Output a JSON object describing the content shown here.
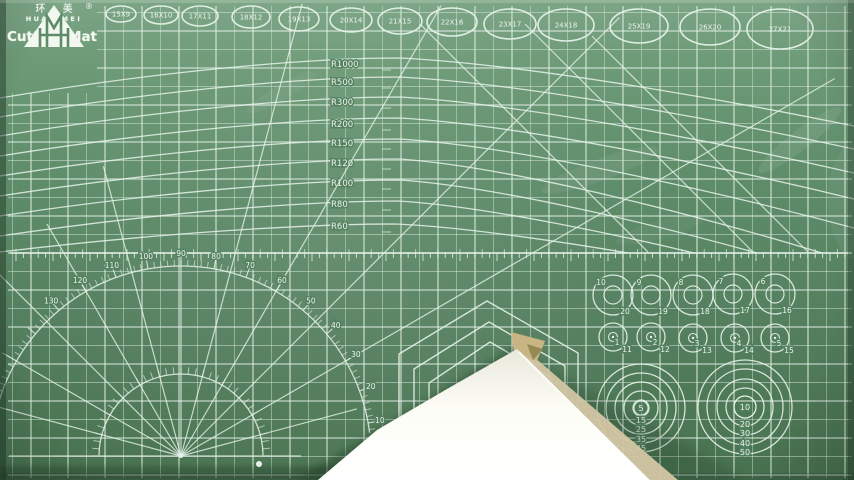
{
  "colors": {
    "mat_top": "#7ca585",
    "mat_mid": "#5e8c69",
    "mat_low": "#547f5e",
    "mat_bottom": "#48724f",
    "grid_line": "#d8e9de",
    "grid_major": "#e6f3ea",
    "template_line": "#e6f2ea",
    "text": "#f3f9f3",
    "halo": "#53805e",
    "paper_white": "#fdfdf6",
    "paper_grey": "#efeee3",
    "paper_beige": "#d3c6a4",
    "fold_tan": "#c9b583",
    "fold_olive": "#8f854f",
    "shadow": "#1c3424"
  },
  "brand": {
    "logo_mark": "HM",
    "registered": "®",
    "name_cn": "环 美",
    "name_en": "HUAN MEI",
    "product": "Cutting Mat"
  },
  "grid": {
    "x0": 12.5,
    "y0": 12.5,
    "step": 18.5,
    "x_min": 8,
    "x_max": 852,
    "y_min": 6,
    "y_max": 478
  },
  "ruler": {
    "y": 253,
    "tick_step": 7.4,
    "tick_len": 5,
    "major_every": 5,
    "x_start": 16,
    "x_end": 850
  },
  "ellipse_templates": [
    {
      "label": "15X9",
      "cx": 121,
      "cy": 14,
      "rx": 15,
      "ry": 8
    },
    {
      "label": "16X10",
      "cx": 161,
      "cy": 15,
      "rx": 17,
      "ry": 9
    },
    {
      "label": "17X11",
      "cx": 200,
      "cy": 16,
      "rx": 18,
      "ry": 10
    },
    {
      "label": "18X12",
      "cx": 251,
      "cy": 17,
      "rx": 19,
      "ry": 11
    },
    {
      "label": "19X13",
      "cx": 299,
      "cy": 19,
      "rx": 20,
      "ry": 12
    },
    {
      "label": "20X14",
      "cx": 351,
      "cy": 20,
      "rx": 21,
      "ry": 12
    },
    {
      "label": "21X15",
      "cx": 400,
      "cy": 21,
      "rx": 22,
      "ry": 13
    },
    {
      "label": "22X16",
      "cx": 452,
      "cy": 22,
      "rx": 25,
      "ry": 14
    },
    {
      "label": "23X17",
      "cx": 510,
      "cy": 24,
      "rx": 26,
      "ry": 15
    },
    {
      "label": "24X18",
      "cx": 566,
      "cy": 25,
      "rx": 28,
      "ry": 16
    },
    {
      "label": "25X19",
      "cx": 639,
      "cy": 26,
      "rx": 29,
      "ry": 17
    },
    {
      "label": "26X20",
      "cx": 710,
      "cy": 27,
      "rx": 30,
      "ry": 18
    },
    {
      "label": "27X21",
      "cx": 780,
      "cy": 29,
      "rx": 33,
      "ry": 20
    }
  ],
  "radius_arcs": {
    "label_x": 331,
    "vertex_tick_x": 382,
    "items": [
      {
        "label": "R1000",
        "label_y": 64,
        "left_y": 98,
        "crest": [
          400,
          58
        ],
        "end": [
          854,
          126
        ]
      },
      {
        "label": "R500",
        "label_y": 82,
        "left_y": 117,
        "crest": [
          400,
          77
        ],
        "end": [
          854,
          149
        ]
      },
      {
        "label": "R300",
        "label_y": 102,
        "left_y": 136,
        "crest": [
          400,
          97
        ],
        "end": [
          854,
          173
        ]
      },
      {
        "label": "R200",
        "label_y": 124,
        "left_y": 156,
        "crest": [
          400,
          118
        ],
        "end": [
          854,
          199
        ]
      },
      {
        "label": "R150",
        "label_y": 143,
        "left_y": 176,
        "crest": [
          400,
          139
        ],
        "end": [
          854,
          228
        ]
      },
      {
        "label": "R120",
        "label_y": 163,
        "left_y": 196,
        "crest": [
          400,
          159
        ],
        "end": [
          822,
          253
        ]
      },
      {
        "label": "R100",
        "label_y": 183,
        "left_y": 216,
        "crest": [
          400,
          180
        ],
        "end": [
          757,
          253
        ]
      },
      {
        "label": "R80",
        "label_y": 204,
        "left_y": 236,
        "crest": [
          398,
          201
        ],
        "end": [
          694,
          253
        ]
      },
      {
        "label": "R60",
        "label_y": 226,
        "left_y": 252,
        "crest": [
          396,
          224
        ],
        "end": [
          628,
          253
        ]
      }
    ]
  },
  "diagonals": [
    {
      "x1": 420,
      "y1": 24,
      "x2": 648,
      "y2": 252
    },
    {
      "x1": 525,
      "y1": 24,
      "x2": 753,
      "y2": 252
    },
    {
      "x1": 592,
      "y1": 36,
      "x2": 808,
      "y2": 252
    }
  ],
  "protractor": {
    "cx": 181,
    "cy": 456,
    "inner_radius": 82,
    "outer_radius": 190,
    "label_radius": 196,
    "degree_labels": [
      {
        "text": "10",
        "angle": 10
      },
      {
        "text": "20",
        "angle": 20
      },
      {
        "text": "30",
        "angle": 30
      },
      {
        "text": "40",
        "angle": 40
      },
      {
        "text": "50",
        "angle": 50
      },
      {
        "text": "60",
        "angle": 60
      },
      {
        "text": "70",
        "angle": 70
      },
      {
        "text": "80",
        "angle": 80
      },
      {
        "text": "90",
        "angle": 90
      },
      {
        "text": "100",
        "angle": 100
      },
      {
        "text": "110",
        "angle": 110
      },
      {
        "text": "120",
        "angle": 120
      },
      {
        "text": "130",
        "angle": 130
      }
    ],
    "rays": [
      {
        "angle": 0,
        "len": 120
      },
      {
        "angle": 15,
        "len": 182
      },
      {
        "angle": 30,
        "len": 755
      },
      {
        "angle": 45,
        "len": 620
      },
      {
        "angle": 60,
        "len": 520
      },
      {
        "angle": 75,
        "len": 468
      },
      {
        "angle": 90,
        "len": 196
      },
      {
        "angle": 105,
        "len": 300
      },
      {
        "angle": 120,
        "len": 268
      },
      {
        "angle": 135,
        "len": 292
      },
      {
        "angle": 150,
        "len": 206
      },
      {
        "angle": 165,
        "len": 190
      },
      {
        "angle": 180,
        "len": 172
      }
    ]
  },
  "chevrons": [
    {
      "points": [
        [
          399,
          472
        ],
        [
          399,
          354
        ],
        [
          487,
          301
        ],
        [
          578,
          353
        ],
        [
          578,
          420
        ]
      ]
    },
    {
      "points": [
        [
          414,
          472
        ],
        [
          414,
          369
        ],
        [
          489,
          322
        ],
        [
          565,
          366
        ],
        [
          565,
          412
        ]
      ]
    },
    {
      "points": [
        [
          429,
          472
        ],
        [
          429,
          383
        ],
        [
          490,
          342
        ],
        [
          552,
          378
        ],
        [
          552,
          404
        ]
      ]
    }
  ],
  "circle_templates": {
    "row1_outer_r": 20,
    "row1_inner_r": 9,
    "row1": [
      {
        "inner_label": "10",
        "outer_label": "20",
        "cx": 613,
        "cy": 295
      },
      {
        "inner_label": "9",
        "outer_label": "19",
        "cx": 651,
        "cy": 295
      },
      {
        "inner_label": "8",
        "outer_label": "18",
        "cx": 693,
        "cy": 295
      },
      {
        "inner_label": "7",
        "outer_label": "17",
        "cx": 733,
        "cy": 294
      },
      {
        "inner_label": "6",
        "outer_label": "16",
        "cx": 775,
        "cy": 294
      }
    ],
    "row2_outer_r": 14,
    "row2_inner_r": 4.5,
    "row2": [
      {
        "label": "1",
        "sub_label": "11",
        "cx": 613,
        "cy": 337
      },
      {
        "label": "2",
        "sub_label": "12",
        "cx": 651,
        "cy": 337
      },
      {
        "label": "3",
        "sub_label": "13",
        "cx": 693,
        "cy": 338
      },
      {
        "label": "4",
        "sub_label": "14",
        "cx": 735,
        "cy": 338
      },
      {
        "label": "5",
        "sub_label": "15",
        "cx": 775,
        "cy": 338
      }
    ]
  },
  "bullseyes": [
    {
      "name": "left",
      "cx": 641,
      "cy": 408,
      "rings": [
        8,
        17,
        26,
        35,
        44
      ],
      "center_ring": 7,
      "center_label": "5",
      "labels": [
        {
          "text": "15",
          "y": 420
        },
        {
          "text": "25",
          "y": 429
        },
        {
          "text": "35",
          "y": 439
        },
        {
          "text": "45",
          "y": 448
        }
      ]
    },
    {
      "name": "right",
      "cx": 745,
      "cy": 407,
      "rings": [
        11,
        19,
        28,
        38,
        47
      ],
      "center_ring": 11,
      "center_label": "10",
      "labels": [
        {
          "text": "20",
          "y": 424
        },
        {
          "text": "30",
          "y": 433
        },
        {
          "text": "40",
          "y": 443
        },
        {
          "text": "50",
          "y": 452
        }
      ]
    }
  ],
  "paper": {
    "white_poly": [
      [
        517,
        349
      ],
      [
        447,
        389
      ],
      [
        377,
        430
      ],
      [
        318,
        480
      ],
      [
        650,
        480
      ]
    ],
    "beige_poly": [
      [
        520,
        352
      ],
      [
        650,
        480
      ],
      [
        678,
        480
      ],
      [
        534,
        357
      ]
    ],
    "fold_poly": [
      [
        511,
        332
      ],
      [
        545,
        341
      ],
      [
        537,
        361
      ],
      [
        514,
        352
      ]
    ],
    "fold_dark_poly": [
      [
        527,
        344
      ],
      [
        543,
        349
      ],
      [
        533,
        360
      ]
    ],
    "shadow_right_poly": [
      [
        520,
        352
      ],
      [
        748,
        480
      ],
      [
        642,
        480
      ]
    ],
    "shadow_left_poly": [
      [
        513,
        347
      ],
      [
        296,
        480
      ],
      [
        346,
        480
      ],
      [
        516,
        353
      ]
    ],
    "bottom_shadow": {
      "x": 0,
      "y": 466,
      "w": 348,
      "h": 14
    },
    "edge_highlight": [
      [
        519,
        352
      ],
      [
        648,
        480
      ]
    ],
    "glare_dot": {
      "x": 259,
      "y": 464,
      "r": 3
    }
  },
  "scuffs": [
    {
      "cx": 600,
      "cy": 170,
      "rx": 62,
      "ry": 11,
      "rot": -20,
      "op": 0.07
    },
    {
      "cx": 800,
      "cy": 140,
      "rx": 52,
      "ry": 10,
      "rot": -38,
      "op": 0.09
    },
    {
      "cx": 282,
      "cy": 92,
      "rx": 40,
      "ry": 8,
      "rot": -30,
      "op": 0.06
    },
    {
      "cx": 660,
      "cy": 230,
      "rx": 46,
      "ry": 9,
      "rot": -15,
      "op": 0.05
    },
    {
      "cx": 858,
      "cy": 200,
      "rx": 30,
      "ry": 60,
      "rot": 0,
      "op": 0.06
    }
  ]
}
